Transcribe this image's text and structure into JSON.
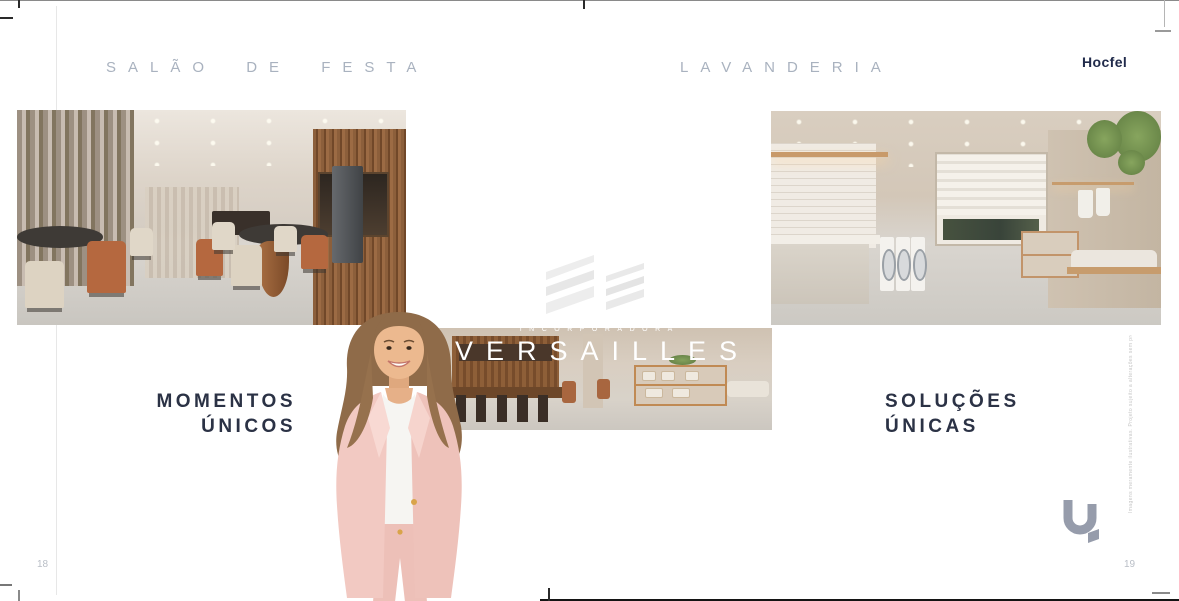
{
  "brand": {
    "name": "Hocfel",
    "logo_mark": "U."
  },
  "left_page": {
    "heading": "SALÃO DE FESTA",
    "caption_line1": "MOMENTOS",
    "caption_line2": "ÚNICOS",
    "page_number": "18"
  },
  "right_page": {
    "heading": "LAVANDERIA",
    "caption_line1": "SOLUÇÕES",
    "caption_line2": "ÚNICAS",
    "page_number": "19",
    "vertical_disclaimer": "Imagens meramente ilustrativas. Projeto sujeito a alterações sem prévio aviso."
  },
  "watermark": {
    "upper_text": "INCORPORADORA",
    "name": "VERSAILLES"
  },
  "colors": {
    "heading_text": "#a9b2bf",
    "caption_text": "#2b3245",
    "brand_text": "#212b4b",
    "page_number": "#b9bec6",
    "logo_mark": "#969cab",
    "watermark_text": "#ffffff",
    "model_suit_pink": "#f0c7c0"
  }
}
